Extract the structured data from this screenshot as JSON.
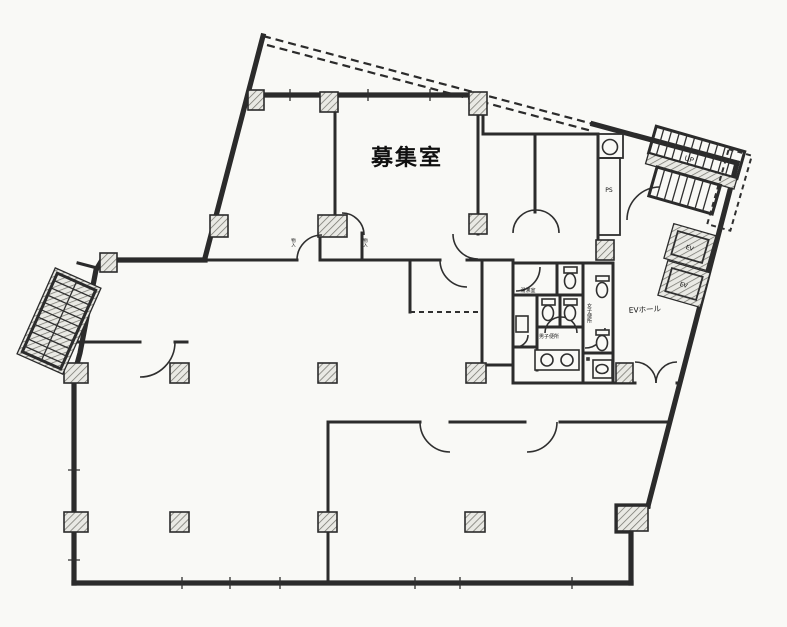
{
  "colors": {
    "background": "#f9f9f6",
    "wall": "#2b2b2b",
    "hatch_line": "#75756e",
    "hatch_bg": "#e9e9e4",
    "text": "#101010"
  },
  "labels": {
    "main_room": "募集室",
    "ev_hall": "EVホール",
    "mens_toilet": "男子便所",
    "womens_toilet": "女子便所",
    "kitchenette": "湯沸室",
    "pipe_shaft": "PS",
    "elevator_1": "EV",
    "elevator_2": "EV",
    "stairs_direction": "UP",
    "closet_left": "物入",
    "closet_right": "物入"
  }
}
